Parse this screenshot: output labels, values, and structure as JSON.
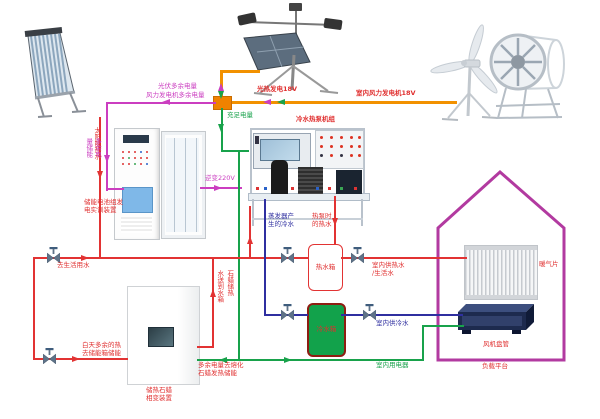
{
  "colors": {
    "power_pv_wind": "#f29100",
    "surplus_power": "#cb3ec0",
    "sufficient_power": "#18a24b",
    "hot_water": "#e23333",
    "cold_water": "#2f2fa0",
    "house_outline": "#b23aa0",
    "cold_tank_fill": "#12a24b"
  },
  "labels": {
    "solar_hot_water": "太阳能热水",
    "pv_generation": "光热发电18V",
    "wind_generation": "室内风力发电机18V",
    "pv_surplus": "光伏多余电量",
    "wind_surplus": "风力发电机多余电量",
    "surplus_storage": "多余电\n量储能",
    "sufficient_power": "充足电量",
    "inverter_220v": "逆变220V",
    "battery_device": "储能电池组发\n电实训装置",
    "heat_pump_unit": "冷水热泵机组",
    "evaporator_cold": "蒸发器产\n生的冷水",
    "heat_pump_hot": "热泵时\n的热水",
    "hot_water_tank": "热水箱",
    "cold_water_tank": "冷水箱",
    "to_domestic_water": "去生活用水",
    "indoor_hot_water": "室内供热水\n/生活水",
    "indoor_cold_water": "室内供冷水",
    "indoor_appliances": "室内用电器",
    "radiator": "暖气片",
    "fan_coil": "风机盘管",
    "load_platform": "负载平台",
    "daytime_surplus_heat": "白天多余的热\n去储能箱储能",
    "water_to_tank": "水送到水箱",
    "paraffin_storage": "石蜡储热",
    "surplus_melt_paraffin": "多余电量去熔化\n石蜡发热储能",
    "paraffin_device": "储热石蜡\n相变装置"
  }
}
